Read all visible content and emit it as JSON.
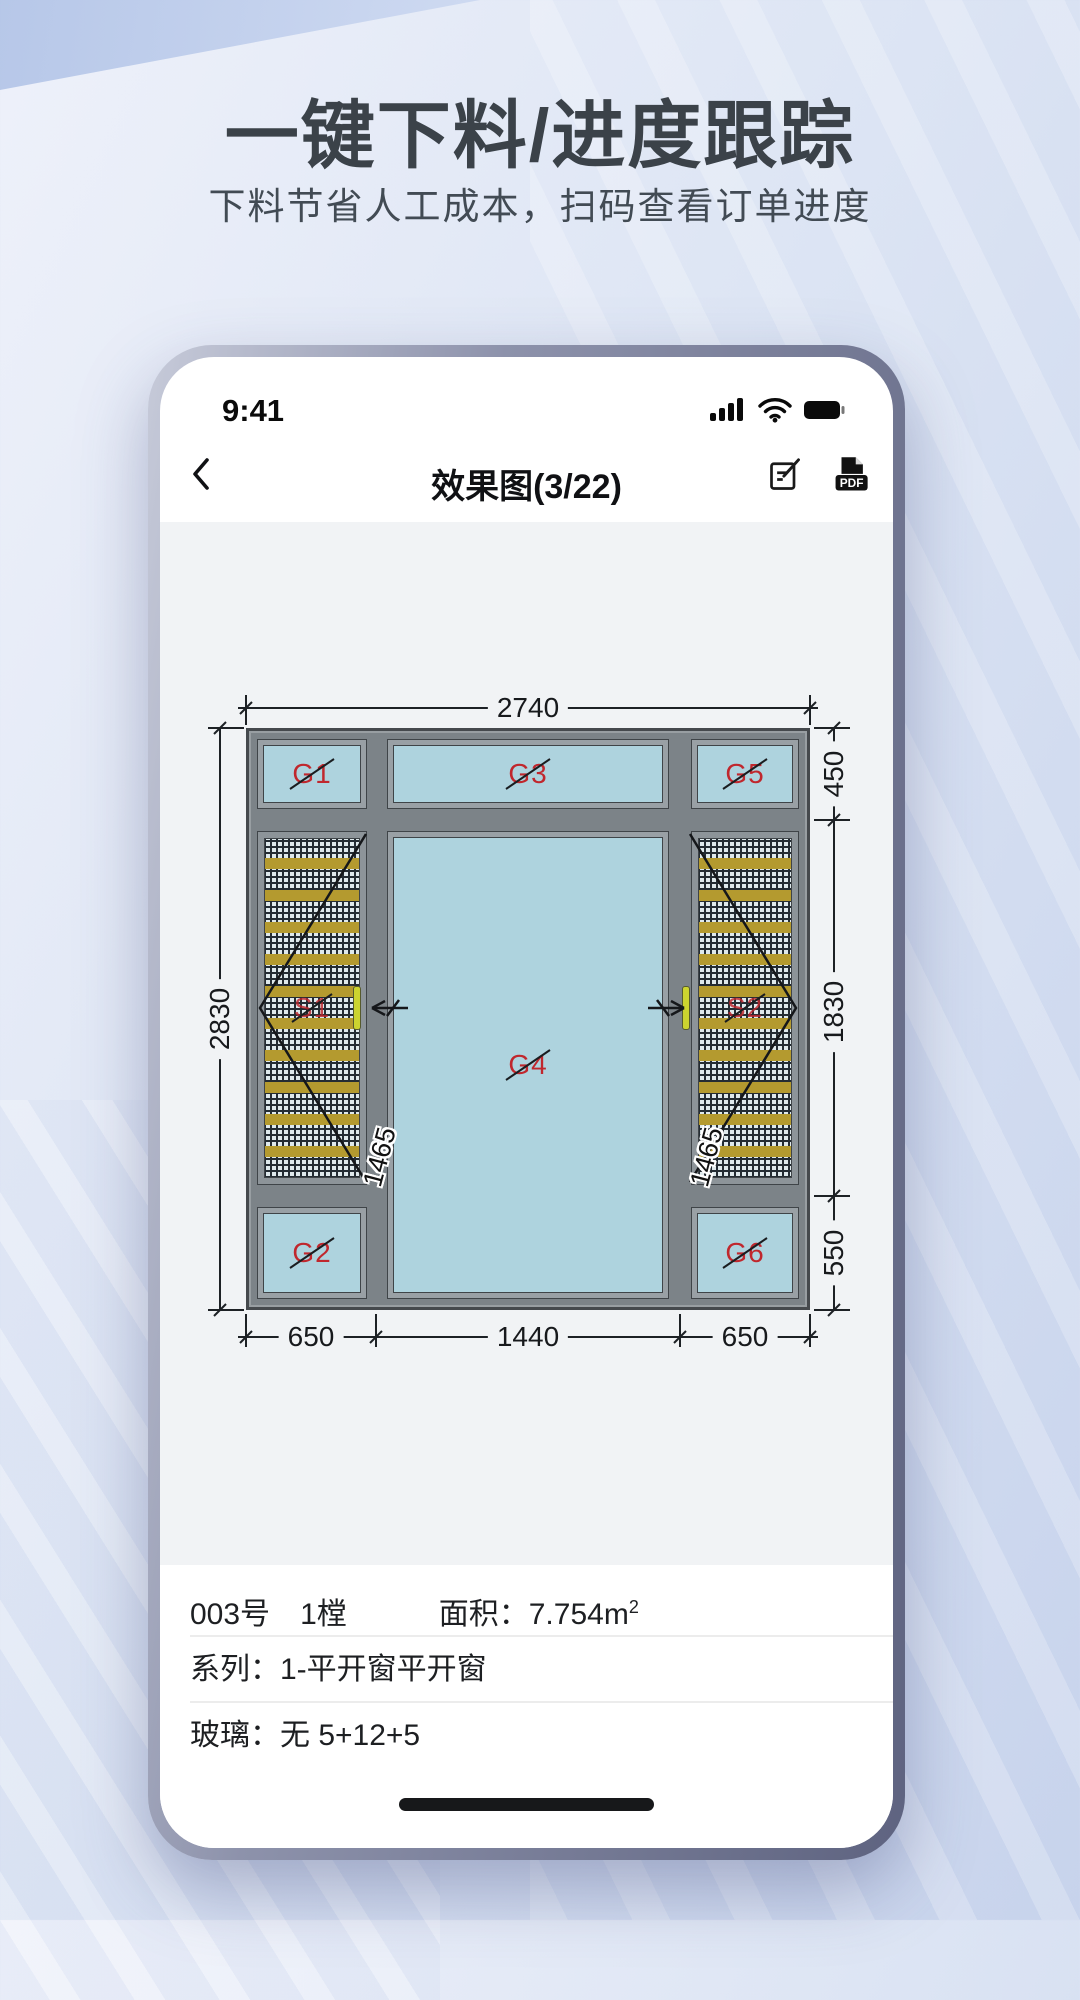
{
  "hero": {
    "title": "一键下料/进度跟踪",
    "subtitle": "下料节省人工成本，扫码查看订单进度"
  },
  "status": {
    "time": "9:41"
  },
  "nav": {
    "title": "效果图(3/22)",
    "pdf_badge": "PDF"
  },
  "drawing": {
    "dims": {
      "width_total": "2740",
      "height_total": "2830",
      "right_top": "450",
      "right_mid": "1830",
      "right_bottom": "550",
      "bottom_left": "650",
      "bottom_mid": "1440",
      "bottom_right": "650",
      "sash_left": "1465",
      "sash_right": "1465"
    },
    "glass_labels": {
      "g1": "G1",
      "g2": "G2",
      "g3": "G3",
      "g4": "G4",
      "g5": "G5",
      "g6": "G6"
    },
    "screen_labels": {
      "s1": "S1",
      "s2": "S2"
    }
  },
  "info": {
    "order_no": "003号",
    "count": "1樘",
    "area_label": "面积：",
    "area_value": "7.754m",
    "area_sup": "2",
    "series": "系列：1-平开窗平开窗",
    "glass": "玻璃：无 5+12+5"
  },
  "colors": {
    "accent_red": "#c0272d",
    "glass_blue": "#aed3de",
    "frame_gray": "#7c8388",
    "mesh_yellow": "#b49a2f"
  }
}
